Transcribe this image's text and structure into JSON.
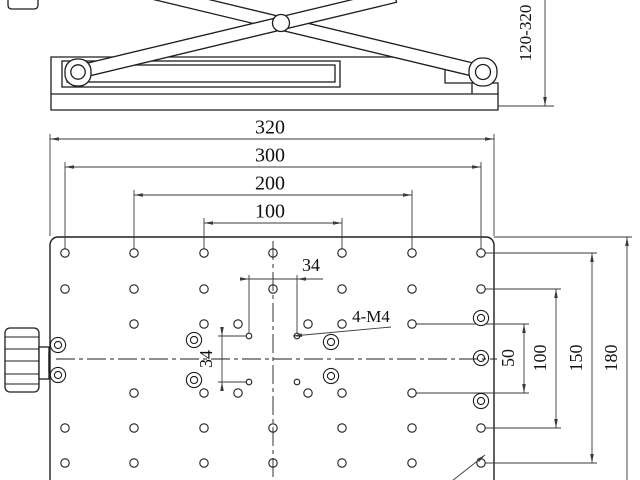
{
  "colors": {
    "object_line": "#1e1e1e",
    "dim_line": "#3a3a3a",
    "text": "#101010",
    "bg": "#ffffff"
  },
  "side_view": {
    "height_range_label": "120-320"
  },
  "top_view": {
    "width_dims": [
      {
        "label": "320",
        "y": 139,
        "x1": 50,
        "x2": 494,
        "tx": 270,
        "ty": 129,
        "ext": [
          [
            50,
            134,
            50,
            236
          ],
          [
            494,
            134,
            494,
            236
          ]
        ]
      },
      {
        "label": "300",
        "y": 167,
        "x1": 65,
        "x2": 481,
        "tx": 270,
        "ty": 157,
        "ext": [
          [
            65,
            162,
            65,
            253
          ],
          [
            481,
            162,
            481,
            253
          ]
        ]
      },
      {
        "label": "200",
        "y": 195,
        "x1": 134,
        "x2": 412,
        "tx": 270,
        "ty": 185,
        "ext": [
          [
            134,
            190,
            134,
            253
          ],
          [
            412,
            190,
            412,
            253
          ]
        ]
      },
      {
        "label": "100",
        "y": 223,
        "x1": 204,
        "x2": 342,
        "tx": 270,
        "ty": 213,
        "ext": [
          [
            204,
            218,
            204,
            253
          ],
          [
            342,
            218,
            342,
            253
          ]
        ]
      }
    ],
    "height_dims": [
      {
        "label": "50",
        "x": 524,
        "y1": 324,
        "y2": 393,
        "tx": 510,
        "ty": 358,
        "ext": [
          [
            412,
            324,
            529,
            324
          ],
          [
            412,
            393,
            529,
            393
          ]
        ]
      },
      {
        "label": "100",
        "x": 556,
        "y1": 289,
        "y2": 428,
        "tx": 542,
        "ty": 358,
        "ext": [
          [
            481,
            289,
            561,
            289
          ],
          [
            481,
            428,
            561,
            428
          ]
        ]
      },
      {
        "label": "150",
        "x": 592,
        "y1": 253,
        "y2": 463,
        "tx": 578,
        "ty": 358,
        "ext": [
          [
            481,
            253,
            597,
            253
          ],
          [
            481,
            463,
            597,
            463
          ]
        ]
      },
      {
        "label": "180",
        "x": 627,
        "y1": 237,
        "y2": 481,
        "tx": 613,
        "ty": 358,
        "ext": [
          [
            494,
            237,
            632,
            237
          ]
        ],
        "no_bottom_arrow": true
      }
    ],
    "square_dim_h": {
      "label": "34",
      "tx": 311,
      "ty": 267
    },
    "square_dim_v": {
      "label": "34",
      "tx": 208,
      "ty": 359
    },
    "thread_callout": {
      "label": "4-M4",
      "tx": 371,
      "ty": 318
    },
    "plate": {
      "x": 50,
      "y": 237,
      "w": 444,
      "h": 250,
      "grid_cols": [
        65,
        134,
        204,
        273,
        342,
        412,
        481
      ],
      "full_rows": [
        253,
        289,
        428,
        463
      ],
      "mid_rows": [
        324,
        393
      ],
      "mid_cols": [
        134,
        204,
        238,
        308,
        342,
        412
      ],
      "hole_r": 4.2,
      "m4_holes": [
        [
          249,
          336
        ],
        [
          297,
          336
        ],
        [
          249,
          382
        ],
        [
          297,
          382
        ]
      ],
      "m4_r": 2.8,
      "counterbores": [
        [
          58,
          345
        ],
        [
          58,
          375
        ],
        [
          194,
          340
        ],
        [
          194,
          380
        ],
        [
          331,
          342
        ],
        [
          331,
          376
        ],
        [
          481,
          318
        ],
        [
          481,
          358
        ],
        [
          481,
          401
        ]
      ],
      "cb_r_outer": 7.6,
      "cb_r_inner": 3.6,
      "centerline_h_y": 359,
      "centerline_v_x": 273
    }
  }
}
